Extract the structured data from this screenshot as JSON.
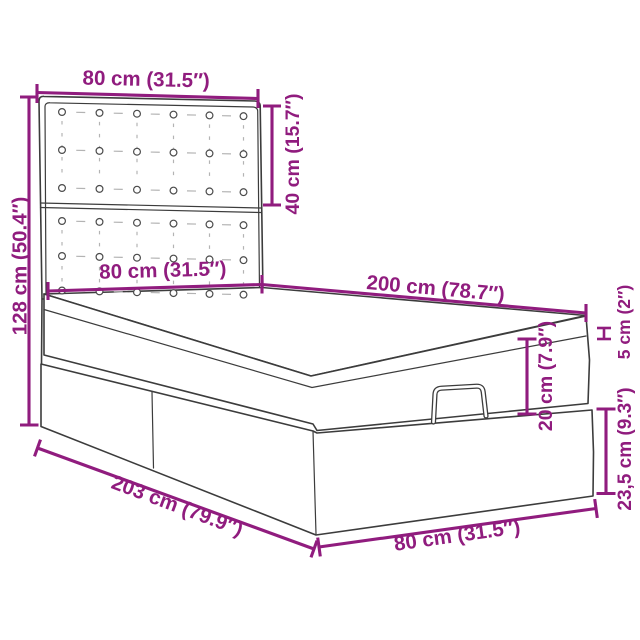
{
  "title": "Ottoman bed with tufted headboard — dimension diagram",
  "colors": {
    "accent": "#901c7e",
    "line": "#3c3c3c",
    "background": "#ffffff"
  },
  "labels": {
    "headboard_width": "80 cm (31.5″)",
    "headboard_height": "40 cm (15.7″)",
    "total_height": "128 cm (50.4″)",
    "bed_width_top": "80 cm (31.5″)",
    "bed_length_top": "200 cm (78.7″)",
    "topper_thickness": "5 cm (2″)",
    "mattress_thickness": "20 cm (7.9″)",
    "base_height": "23,5 cm (9.3″)",
    "total_length": "203 cm (79.9″)",
    "bed_width_bottom": "80 cm (31.5″)"
  }
}
